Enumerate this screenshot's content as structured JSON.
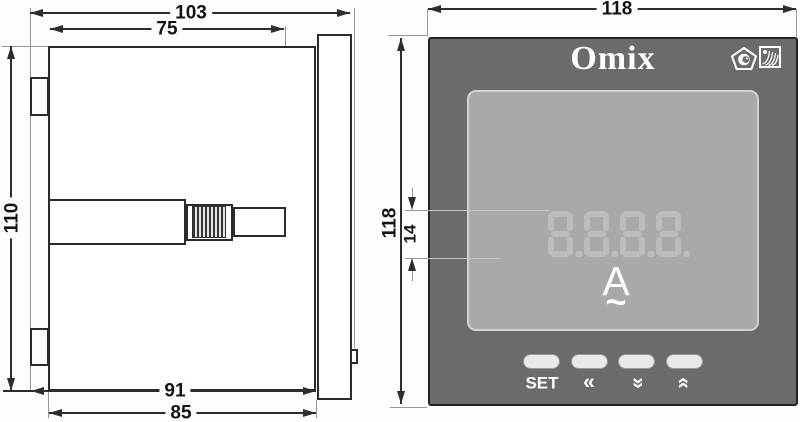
{
  "drawing": {
    "title_hint": "panel meter dimension drawing",
    "side_view": {
      "dim_total_depth": "103",
      "dim_clamp_depth": "75",
      "dim_body_height": "110",
      "dim_depth_with_terminals": "91",
      "dim_body_depth": "85"
    },
    "front_view": {
      "dim_width": "118",
      "dim_height": "118",
      "dim_digit_height": "14",
      "brand": "Omix",
      "display": {
        "digits": "8888",
        "decimal_points": true,
        "unit": "A",
        "ac_symbol": "~"
      },
      "icons": [
        "certification-pentagon-icon",
        "quality-hatch-icon"
      ],
      "buttons": {
        "set": "SET",
        "left": "«",
        "down": "«",
        "up": "«"
      },
      "colors": {
        "panel": "#6b6b6b",
        "display_bg": "#a9a9a9",
        "segment_ghost": "#bcbcbc",
        "button_fill": "#e9e9e9",
        "panel_text": "#ffffff",
        "line": "#2d2d2d"
      }
    }
  }
}
